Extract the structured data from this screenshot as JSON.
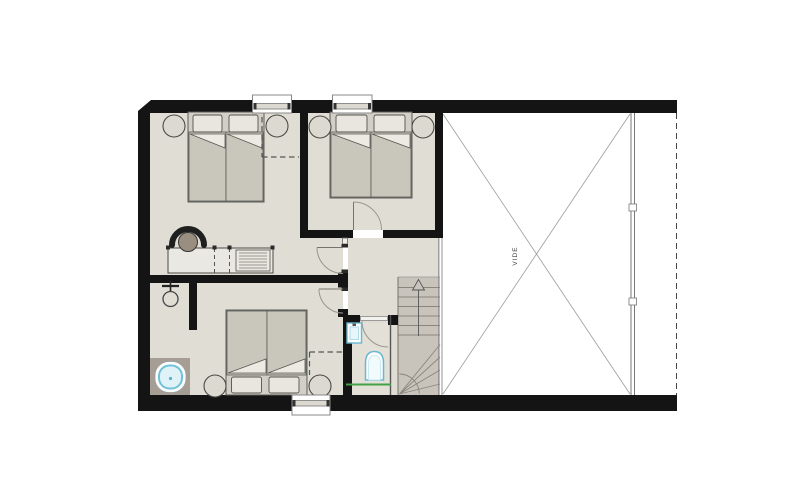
{
  "plan": {
    "title_present": false,
    "void_label": "VIDE",
    "palette": {
      "page_bg": "#ffffff",
      "wall": "#141414",
      "floor": "#e0ddd5",
      "floor_wet_dark": "#a69d94",
      "stair_fill": "#c9c4bb",
      "furniture_fill": "#c9c6bc",
      "furniture_light": "#eae8e2",
      "pillow": "#e8e6df",
      "line_gray": "#8a867e",
      "sanitary_accent": "#6fc2d8",
      "sanitary_basin": "#dff2f8",
      "wet_zone_line": "#43a047",
      "void_cross_line": "#9a9a9a"
    },
    "rooms": [
      {
        "id": "bedroom-1",
        "furniture": [
          "double-single-beds",
          "two-pillows",
          "two-nightstands",
          "desk-with-radiator",
          "armchair"
        ],
        "doors": 1,
        "windows": 1
      },
      {
        "id": "bedroom-2",
        "furniture": [
          "double-single-beds",
          "two-pillows",
          "two-nightstands"
        ],
        "doors": 1,
        "windows": 1
      },
      {
        "id": "bedroom-3",
        "furniture": [
          "double-single-beds",
          "two-pillows",
          "two-nightstands"
        ],
        "doors": 1,
        "windows": 1
      },
      {
        "id": "bathroom-open",
        "fixtures": [
          "shower-mixer",
          "bathtub"
        ]
      },
      {
        "id": "wc",
        "fixtures": [
          "washbasin",
          "toilet"
        ],
        "wet_zone_line": true,
        "doors": 1
      },
      {
        "id": "hallway-landing",
        "doors": 2
      },
      {
        "id": "staircase",
        "type": "winder-stair",
        "direction_arrow": "up"
      },
      {
        "id": "void",
        "label": "VIDE",
        "boundary": [
          "glazed-wall-right",
          "dashed-roof-line"
        ]
      }
    ]
  }
}
